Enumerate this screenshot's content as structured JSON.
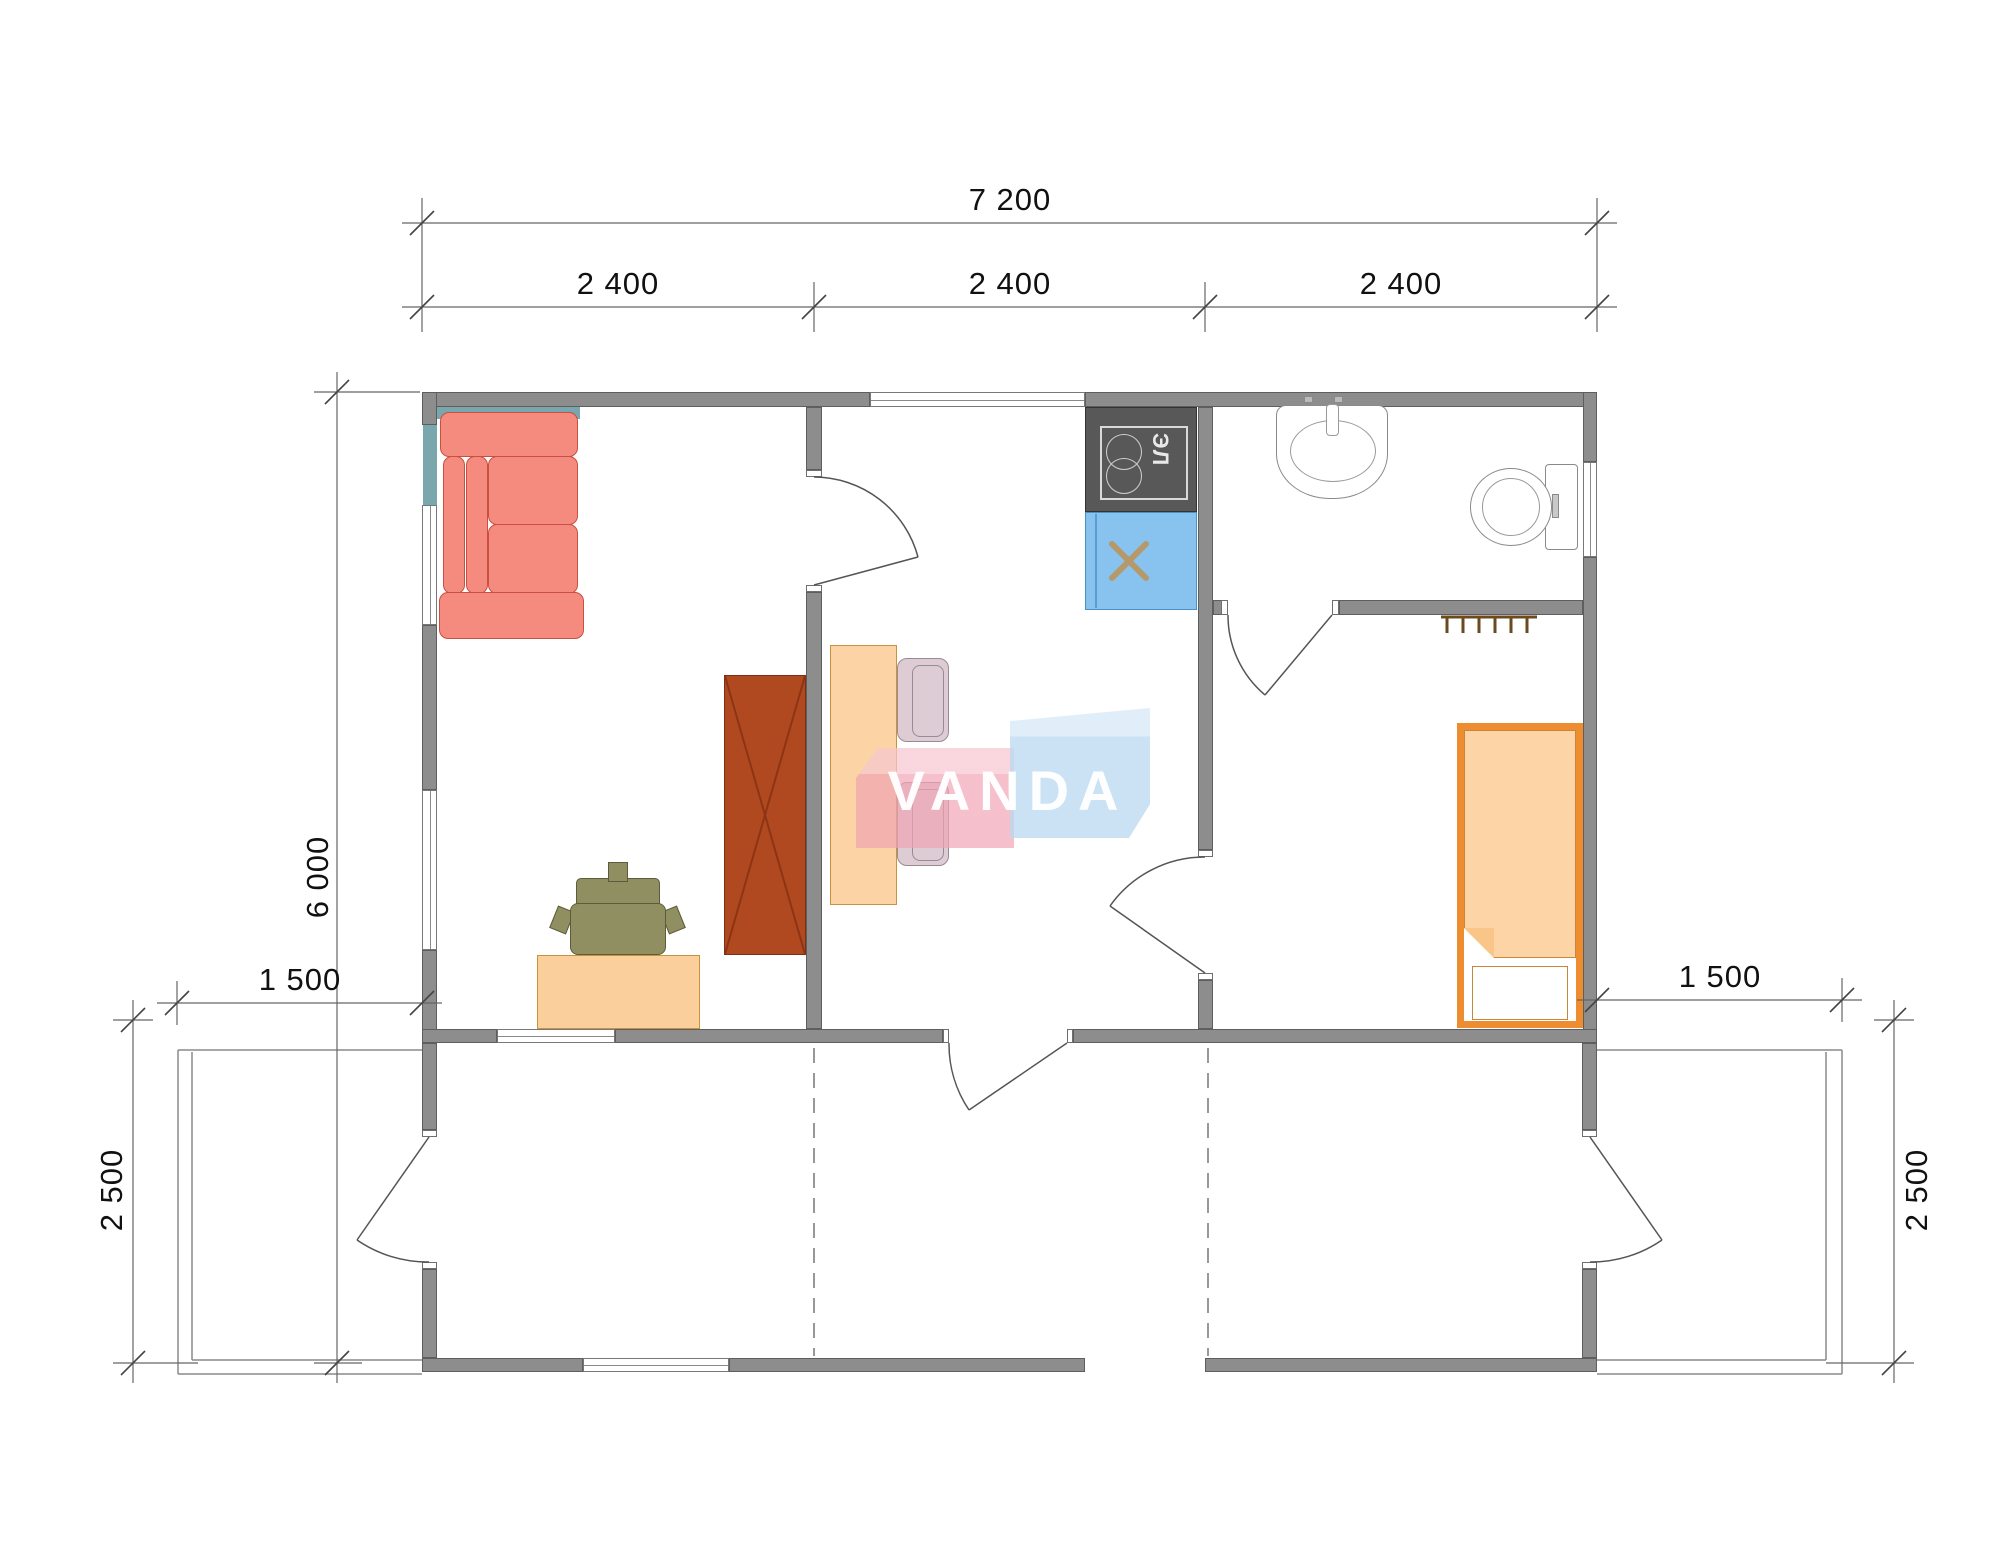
{
  "watermark": {
    "text": "VANDA",
    "pink_color": "#f0a3b4",
    "blue_color": "#bad9f1"
  },
  "dimensions": {
    "overall_width": "7 200",
    "modules": [
      "2 400",
      "2 400",
      "2 400"
    ],
    "overall_depth": "6 000",
    "porch_left_width": "1 500",
    "porch_left_depth": "2 500",
    "porch_right_width": "1 500",
    "porch_right_depth": "2 500"
  },
  "kitchen": {
    "stove_label": "ЭЛ"
  },
  "colors": {
    "wall": "#8d8d8d",
    "wall_edge": "#5e5e5e",
    "sofa": "#f58b7e",
    "sofa_edge": "#c94f40",
    "sofa_shadow_teal": "#7aa7ae",
    "desk_table": "#fbcf9c",
    "office_chair": "#8f8f62",
    "wardrobe": "#b0491f",
    "stove": "#585858",
    "kitchen_sink": "#88c3f0",
    "sink_cross": "#b5996b",
    "bed_frame": "#ee8c30",
    "bed_blanket": "#fcd4a6",
    "dining_chair": "#d9c6cf",
    "coat_rack": "#6b4a20",
    "dimension_text": "#111111"
  },
  "furniture_icons": [
    "sofa",
    "office-desk",
    "office-chair",
    "wardrobe",
    "dining-table",
    "dining-chair",
    "electric-stove-icon",
    "kitchen-sink-icon",
    "washbasin-icon",
    "toilet-icon",
    "coat-rack-icon",
    "single-bed",
    "door-swing-icon",
    "window-icon"
  ]
}
